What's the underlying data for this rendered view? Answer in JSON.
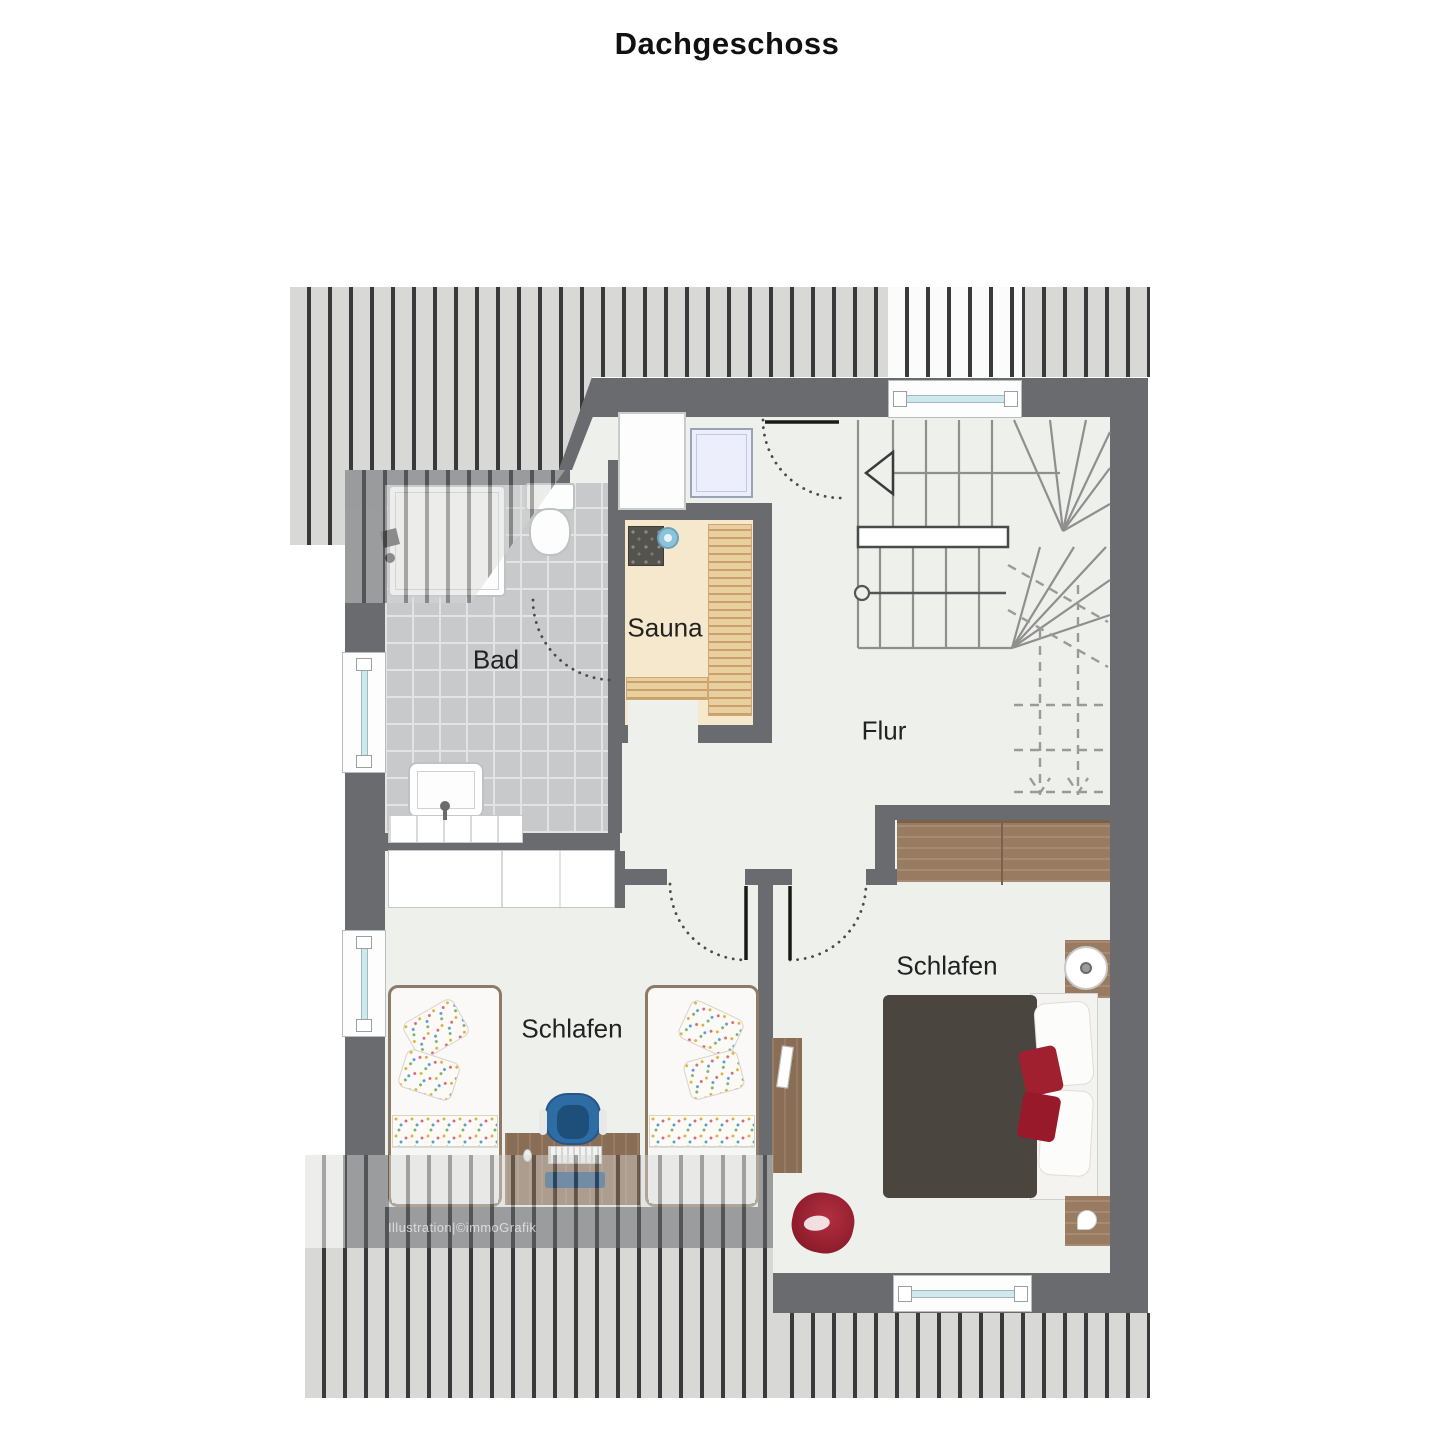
{
  "title": "Dachgeschoss",
  "watermark": "Illustration|©immoGrafik",
  "rooms": [
    {
      "id": "bad",
      "label": "Bad"
    },
    {
      "id": "sauna",
      "label": "Sauna"
    },
    {
      "id": "flur",
      "label": "Flur"
    },
    {
      "id": "schlafen_left",
      "label": "Schlafen"
    },
    {
      "id": "schlafen_right",
      "label": "Schlafen"
    }
  ],
  "colors": {
    "wall": "#696b6f",
    "floor": "#eef0ec",
    "roof_hatch_bg": "#d8d8d6",
    "roof_hatch_line": "#3a3a3c",
    "bath_tiles": "#c7c9cb",
    "sauna_floor": "#f6e8cc",
    "sauna_bench": "#e9cf9f",
    "wood_furniture": "#997b61",
    "bed_duvet": "#4b4540",
    "accent_red": "#a02030",
    "accent_blue": "#2e6da4",
    "window_glass": "#cfe8ee"
  }
}
